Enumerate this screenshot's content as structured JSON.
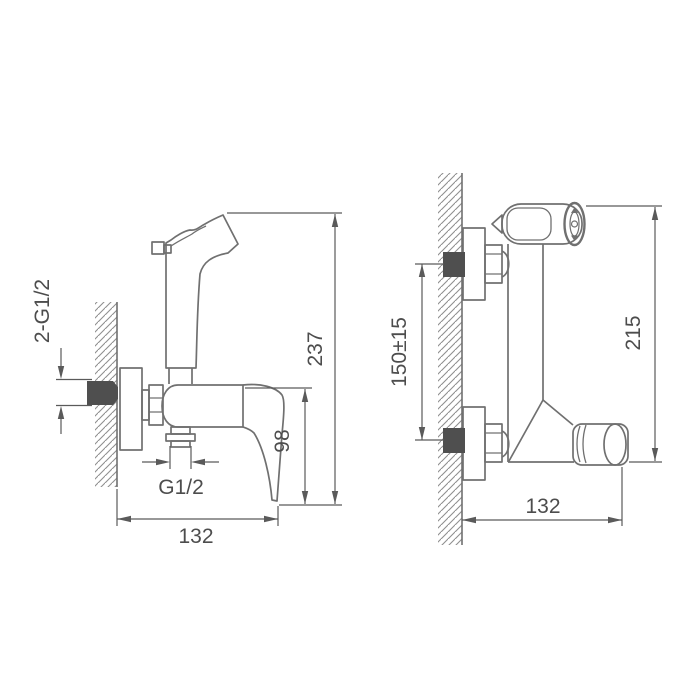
{
  "drawing": {
    "colors": {
      "background": "#ffffff",
      "line": "#707070",
      "dimension": "#5a5a5a",
      "text": "#4d4d4d",
      "dark_fill": "#4f4f4f"
    },
    "left_view": {
      "labels": {
        "inlet_thread": "2-G1/2",
        "total_height": "237",
        "outlet_height": "98",
        "outlet_thread": "G1/2",
        "width": "132"
      }
    },
    "right_view": {
      "labels": {
        "inlet_spacing": "150±15",
        "overall_height": "215",
        "width": "132"
      }
    }
  }
}
